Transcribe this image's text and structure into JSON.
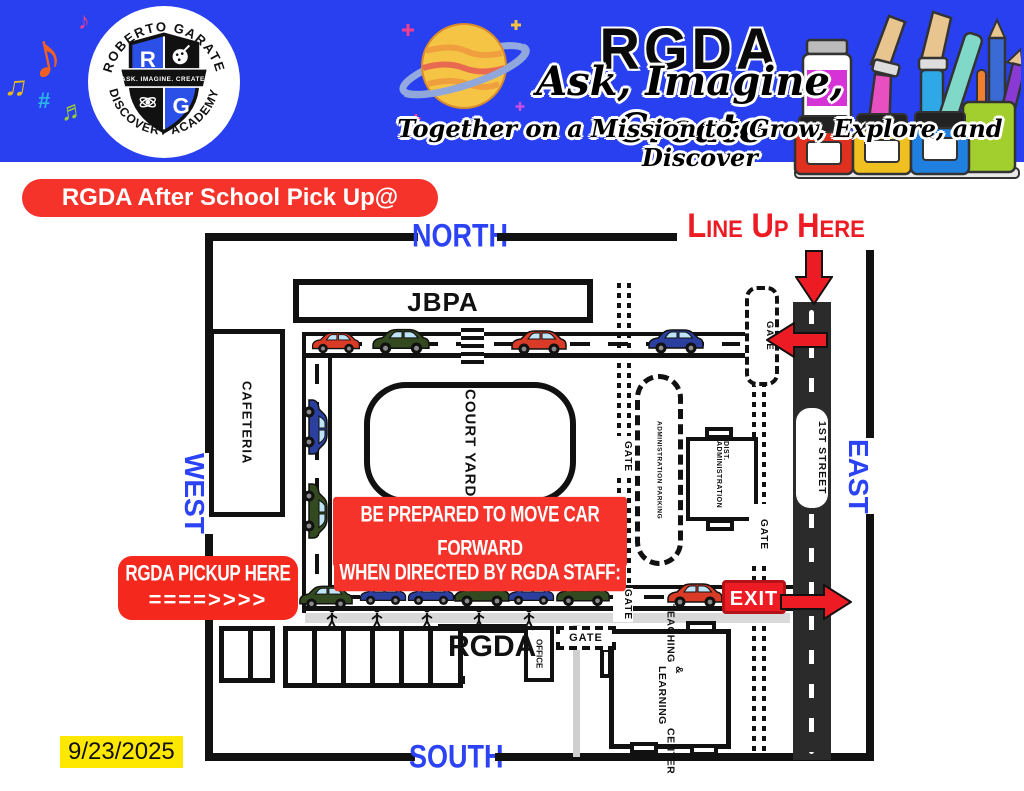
{
  "header": {
    "title": "RGDA",
    "tagline1": "Ask, Imagine, Create",
    "tagline2": "Together on a Mission to: Grow, Explore, and Discover",
    "school_name_top": "ROBERTO GARATE",
    "school_name_bottom": "DISCOVERY ACADEMY",
    "logo_motto": "ASK. IMAGINE. CREATE.",
    "logo_r": "R",
    "logo_g": "G",
    "bg_color": "#2840EF"
  },
  "decor": {
    "notes": [
      "♪",
      "♫",
      "♬",
      "♪"
    ]
  },
  "banner": {
    "text": "RGDA After School Pick Up@ 3:30pm",
    "bg_color": "#F5332B"
  },
  "map": {
    "compass": {
      "north": "NORTH",
      "south": "SOUTH",
      "east": "EAST",
      "west": "WEST"
    },
    "labels": {
      "line_up": "Line Up Here",
      "exit": "EXIT",
      "street": "1ST STREET",
      "gate": "GATE",
      "pickup_line1": "RGDA PICKUP HERE",
      "pickup_line2": "====>>>>",
      "warning_line1": "BE PREPARED TO MOVE CAR FORWARD",
      "warning_line2": "WHEN DIRECTED BY RGDA STAFF:"
    },
    "buildings": {
      "jbpa": "JBPA",
      "cafeteria": "CAFETERIA",
      "courtyard": "COURT YARD",
      "admin_parking": "ADMINISTRATION PARKING",
      "dist_admin": "DIST. ADMINISTRATION",
      "rgda": "RGDA",
      "office": "OFFICE",
      "teaching_line1": "TEACHING",
      "teaching_line2": "& LEARNING",
      "teaching_line3": "CENTER"
    },
    "date": "9/23/2025",
    "colors": {
      "compass_blue": "#2B43F5",
      "annotation_red": "#ED1C24",
      "date_highlight": "#FFE800"
    }
  }
}
